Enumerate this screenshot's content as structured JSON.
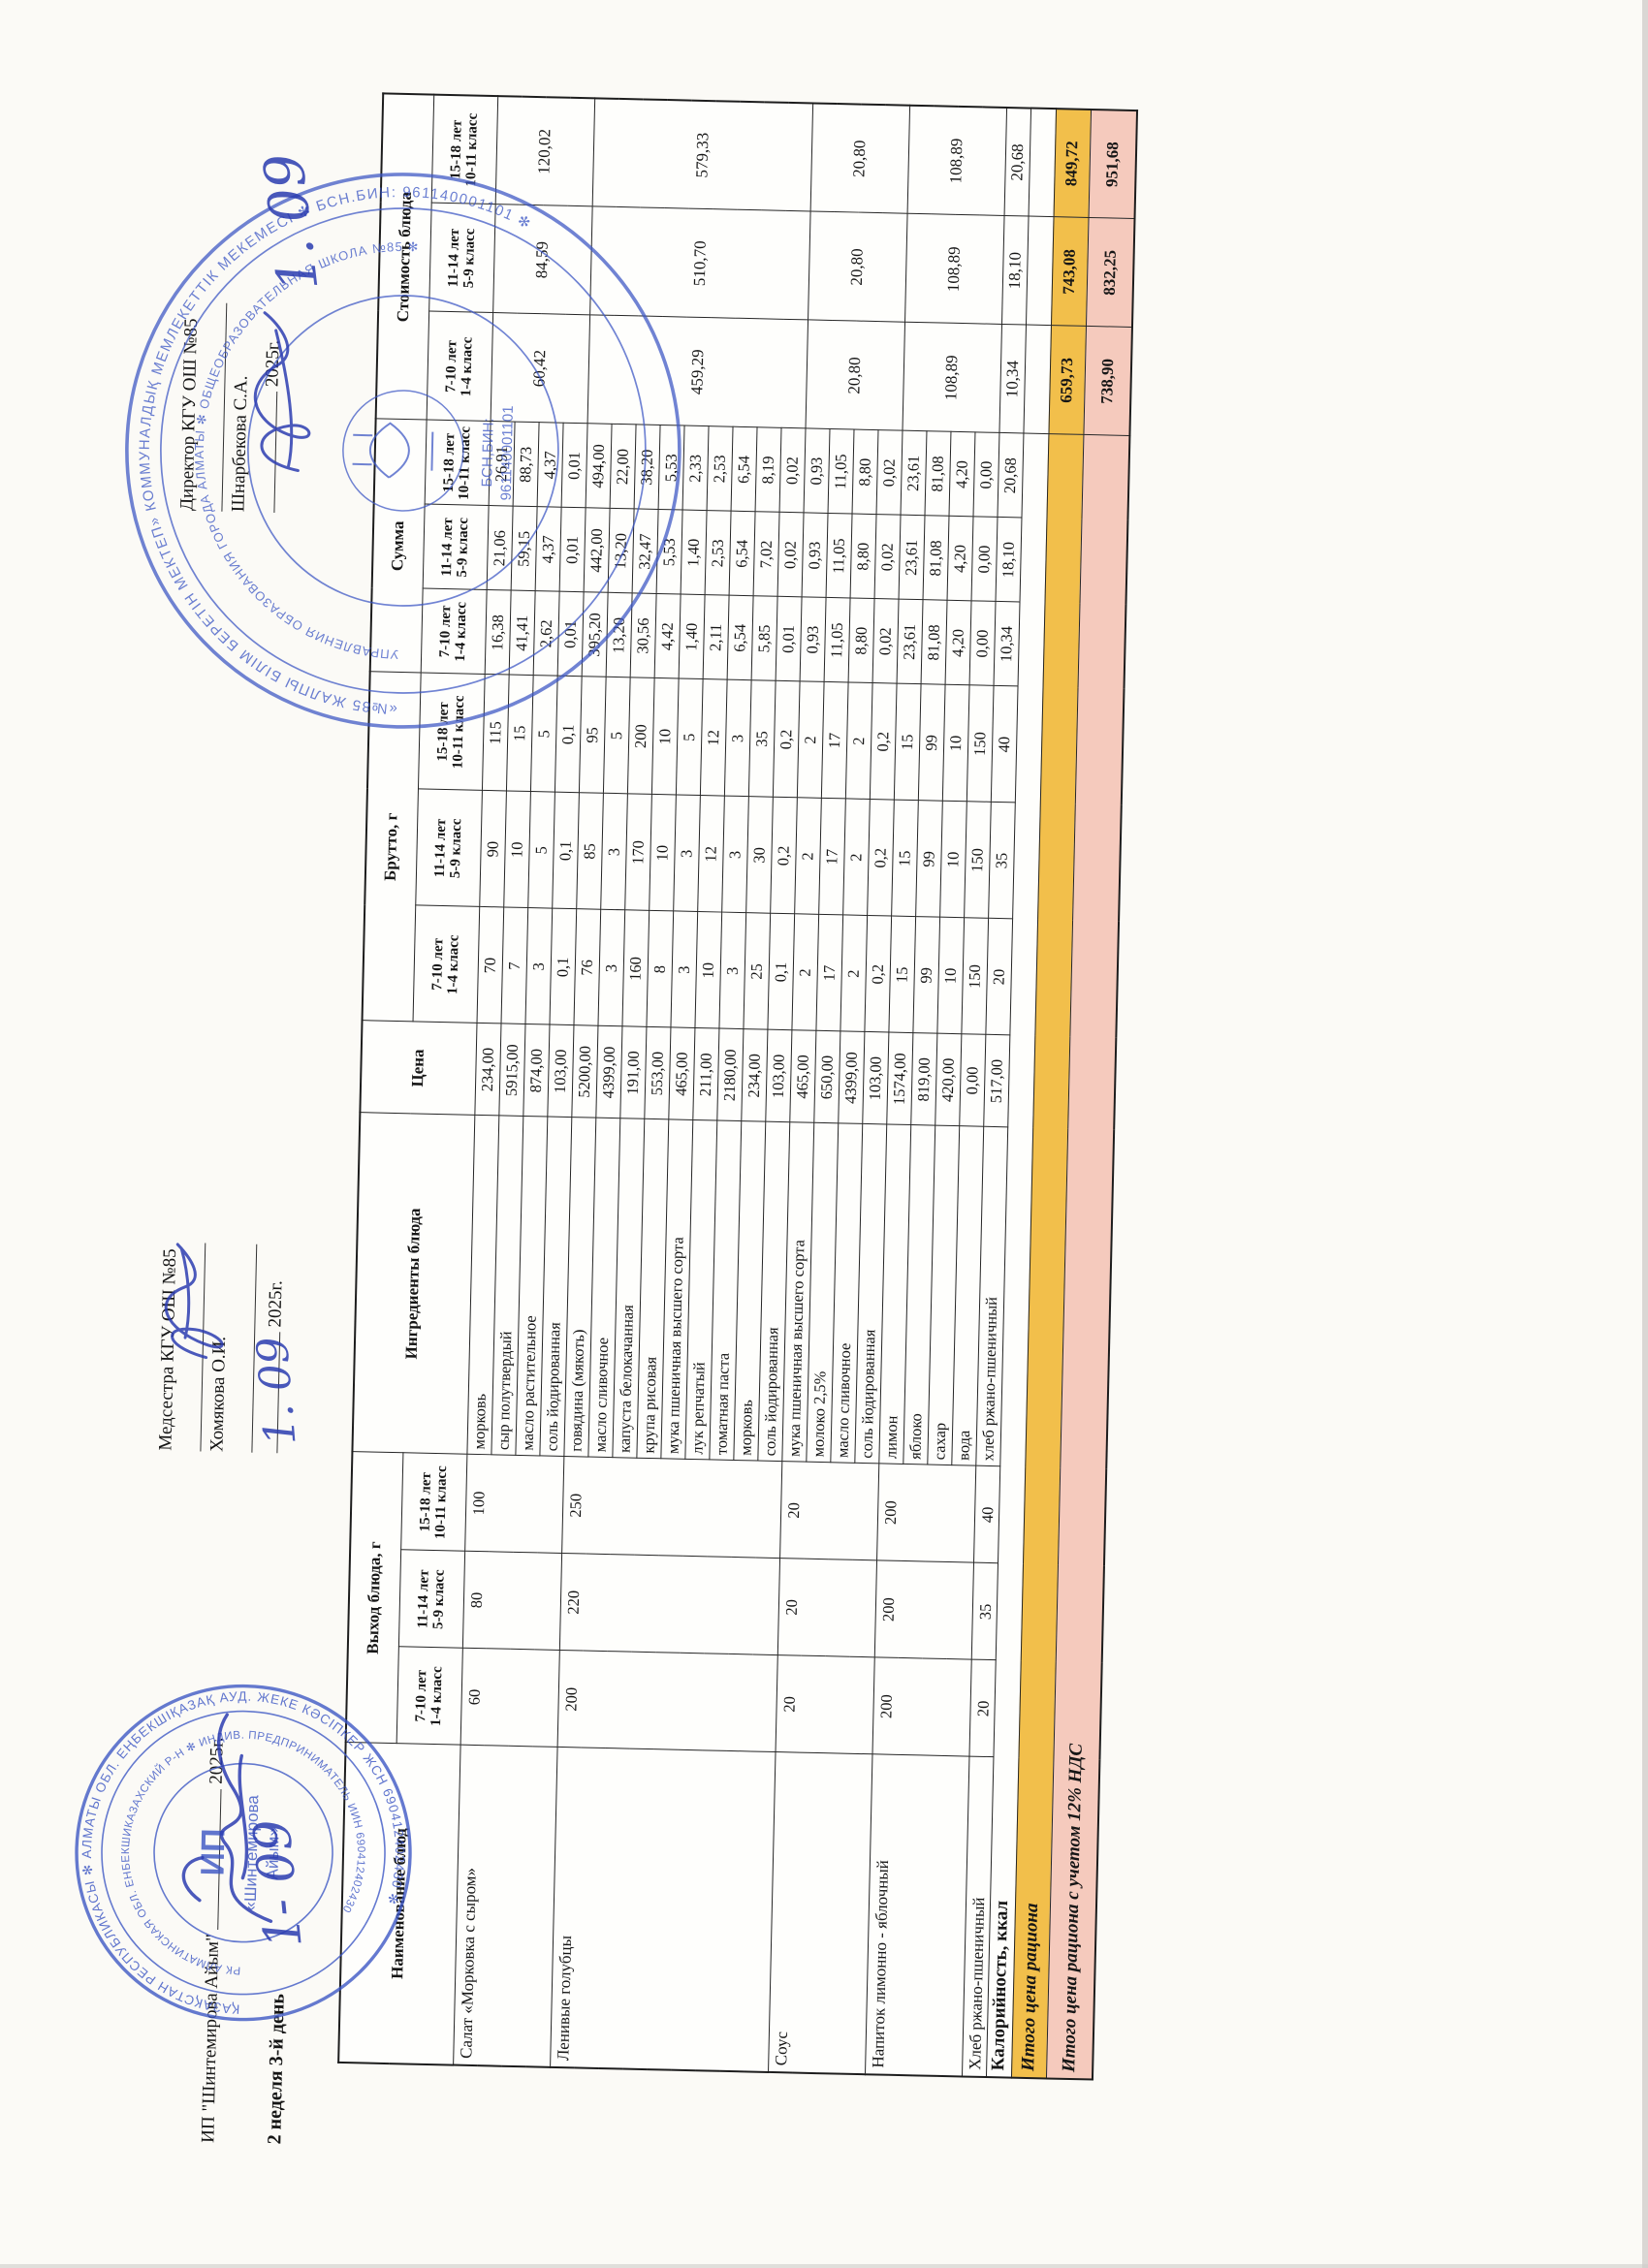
{
  "org": {
    "ip_line": "ИП \"Шинтемирова Айым\"",
    "week_day": "2 неделя 3-й день",
    "nurse_label": "Медсестра КГУ ОШ №85",
    "nurse_name": "Хомякова О.И.",
    "director_label": "Директор КГУ ОШ №85",
    "director_name": "Шнарбекова С.А.",
    "year_suffix": "2025г.",
    "handwritten_date": "1. 09"
  },
  "stamps": {
    "ink_color": "#3a55c4",
    "ip_stamp": {
      "ring_outer": "ҚАЗАҚСТАН РЕСПУБЛИКАСЫ ✻ АЛМАТЫ ОБЛ. ЕҢБЕКШІҚАЗАҚ АУД. ЖЕКЕ КӘСІПКЕР ЖСН 690412402430 ✻ ",
      "ring_inner": "РК АЛМАТИНСКАЯ ОБЛ. ЕНБЕКШИКАЗАХСКИЙ Р-Н ✻ ИНДИВ. ПРЕДПРИНИМАТЕЛЬ ИИН 690412402430 ",
      "center_1": "ИП",
      "center_2": "«Шинтемирова",
      "center_3": "Айым»"
    },
    "school_stamp": {
      "ring_outer": "«№85 ЖАЛПЫ БІЛІМ БЕРЕТІН МЕКТЕП» КОММУНАЛДЫҚ МЕМЛЕКЕТТІК МЕКЕМЕСІ ✻ БСН.БИН: 961140001101 ✻ ",
      "ring_inner": "УПРАВЛЕНИЯ ОБРАЗОВАНИЯ ГОРОДА АЛМАТЫ ✻ ОБЩЕОБРАЗОВАТЕЛЬНАЯ ШКОЛА №85 ✻ ",
      "center_1": "БСН,БИН:",
      "center_2": "961140001101"
    }
  },
  "table": {
    "columns": {
      "name": "Наименование блюд",
      "out": "Выход блюда, г",
      "ingredients": "Ингредиенты блюда",
      "price": "Цена",
      "brutto": "Брутто, г",
      "summa": "Сумма",
      "cost": "Стоимость блюда"
    },
    "age_groups": [
      [
        "7-10 лет",
        "1-4 класс"
      ],
      [
        "11-14 лет",
        "5-9 класс"
      ],
      [
        "15-18 лет",
        "10-11 класс"
      ]
    ],
    "dishes": [
      {
        "name": "Салат «Морковка с сыром»",
        "out": [
          "60",
          "80",
          "100"
        ],
        "cost": [
          "60,42",
          "84,59",
          "120,02"
        ],
        "ingredients": [
          [
            "морковь",
            "234,00",
            "70",
            "90",
            "115",
            "16,38",
            "21,06",
            "26,91"
          ],
          [
            "сыр полутвердый",
            "5915,00",
            "7",
            "10",
            "15",
            "41,41",
            "59,15",
            "88,73"
          ],
          [
            "масло растительное",
            "874,00",
            "3",
            "5",
            "5",
            "2,62",
            "4,37",
            "4,37"
          ],
          [
            "соль йодированная",
            "103,00",
            "0,1",
            "0,1",
            "0,1",
            "0,01",
            "0,01",
            "0,01"
          ]
        ]
      },
      {
        "name": "Ленивые голубцы",
        "out": [
          "200",
          "220",
          "250"
        ],
        "cost": [
          "459,29",
          "510,70",
          "579,33"
        ],
        "ingredients": [
          [
            "говядина (мякоть)",
            "5200,00",
            "76",
            "85",
            "95",
            "395,20",
            "442,00",
            "494,00"
          ],
          [
            "масло сливочное",
            "4399,00",
            "3",
            "3",
            "5",
            "13,20",
            "13,20",
            "22,00"
          ],
          [
            "капуста белокачанная",
            "191,00",
            "160",
            "170",
            "200",
            "30,56",
            "32,47",
            "38,20"
          ],
          [
            "крупа рисовая",
            "553,00",
            "8",
            "10",
            "10",
            "4,42",
            "5,53",
            "5,53"
          ],
          [
            "мука пшеничная высшего сорта",
            "465,00",
            "3",
            "3",
            "5",
            "1,40",
            "1,40",
            "2,33"
          ],
          [
            "лук репчатый",
            "211,00",
            "10",
            "12",
            "12",
            "2,11",
            "2,53",
            "2,53"
          ],
          [
            "томатная паста",
            "2180,00",
            "3",
            "3",
            "3",
            "6,54",
            "6,54",
            "6,54"
          ],
          [
            "морковь",
            "234,00",
            "25",
            "30",
            "35",
            "5,85",
            "7,02",
            "8,19"
          ],
          [
            "соль йодированная",
            "103,00",
            "0,1",
            "0,2",
            "0,2",
            "0,01",
            "0,02",
            "0,02"
          ]
        ]
      },
      {
        "name": "Соус",
        "out": [
          "20",
          "20",
          "20"
        ],
        "cost": [
          "20,80",
          "20,80",
          "20,80"
        ],
        "ingredients": [
          [
            "мука пшеничная высшего сорта",
            "465,00",
            "2",
            "2",
            "2",
            "0,93",
            "0,93",
            "0,93"
          ],
          [
            "молоко 2,5%",
            "650,00",
            "17",
            "17",
            "17",
            "11,05",
            "11,05",
            "11,05"
          ],
          [
            "масло сливочное",
            "4399,00",
            "2",
            "2",
            "2",
            "8,80",
            "8,80",
            "8,80"
          ],
          [
            "соль йодированная",
            "103,00",
            "0,2",
            "0,2",
            "0,2",
            "0,02",
            "0,02",
            "0,02"
          ]
        ]
      },
      {
        "name": "Напиток лимонно - яблочный",
        "out": [
          "200",
          "200",
          "200"
        ],
        "cost": [
          "108,89",
          "108,89",
          "108,89"
        ],
        "ingredients": [
          [
            "лимон",
            "1574,00",
            "15",
            "15",
            "15",
            "23,61",
            "23,61",
            "23,61"
          ],
          [
            "яблоко",
            "819,00",
            "99",
            "99",
            "99",
            "81,08",
            "81,08",
            "81,08"
          ],
          [
            "сахар",
            "420,00",
            "10",
            "10",
            "10",
            "4,20",
            "4,20",
            "4,20"
          ],
          [
            "вода",
            "0,00",
            "150",
            "150",
            "150",
            "0,00",
            "0,00",
            "0,00"
          ]
        ]
      },
      {
        "name": "Хлеб ржано-пшеничный",
        "out": [
          "20",
          "35",
          "40"
        ],
        "cost": [
          "10,34",
          "18,10",
          "20,68"
        ],
        "ingredients": [
          [
            "хлеб ржано-пшеничный",
            "517,00",
            "20",
            "35",
            "40",
            "10,34",
            "18,10",
            "20,68"
          ]
        ]
      }
    ],
    "totals": [
      {
        "label": "Калорийность, ккал",
        "values": [
          "",
          "",
          ""
        ],
        "bg": "#FEFEFC",
        "style": "bold",
        "row_class": "t-kcal"
      },
      {
        "label": "Итого цена рациона",
        "values": [
          "659,73",
          "743,08",
          "849,72"
        ],
        "bg": "#F2BF4B",
        "style": "bold-italic",
        "row_class": "t-sum"
      },
      {
        "label": "Итого цена рациона с учетом 12% НДС",
        "values": [
          "738,90",
          "832,25",
          "951,68"
        ],
        "bg": "#F5CABD",
        "style": "bold-italic",
        "row_class": "t-nds"
      }
    ],
    "highlight_colors": {
      "total_row": "#F2BF4B",
      "total_nds_row": "#F5CABD"
    }
  }
}
